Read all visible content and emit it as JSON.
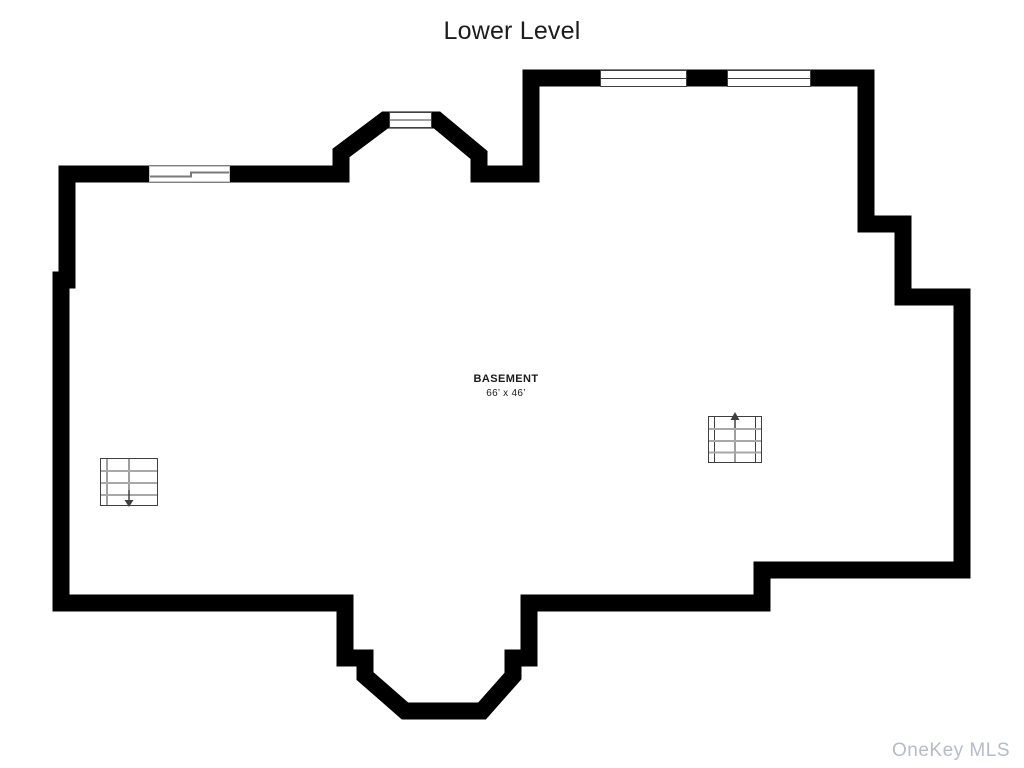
{
  "header": {
    "title": "Lower Level"
  },
  "floorplan": {
    "room": {
      "name": "BASEMENT",
      "dimensions": "66’ x 46’"
    },
    "features": {
      "windows": [
        "top-wall-window-left",
        "top-wall-window-right",
        "bay-window-top"
      ],
      "doors": [
        "sliding-door-left-wall"
      ],
      "stairs": [
        {
          "name": "stairs-left",
          "arrow_direction": "down"
        },
        {
          "name": "stairs-right",
          "arrow_direction": "up"
        }
      ],
      "bays": [
        "top-bay",
        "bottom-bay"
      ]
    }
  },
  "watermark": {
    "text": "OneKey MLS"
  },
  "colors": {
    "wall": "#000000",
    "detail": "#3f3f3f",
    "tread": "#a8a8a8",
    "door": "#7a7a7a",
    "door_frame": "#c9c9c9",
    "text": "#1a1a1a",
    "watermark": "#b7bbc4",
    "bg": "#ffffff"
  }
}
